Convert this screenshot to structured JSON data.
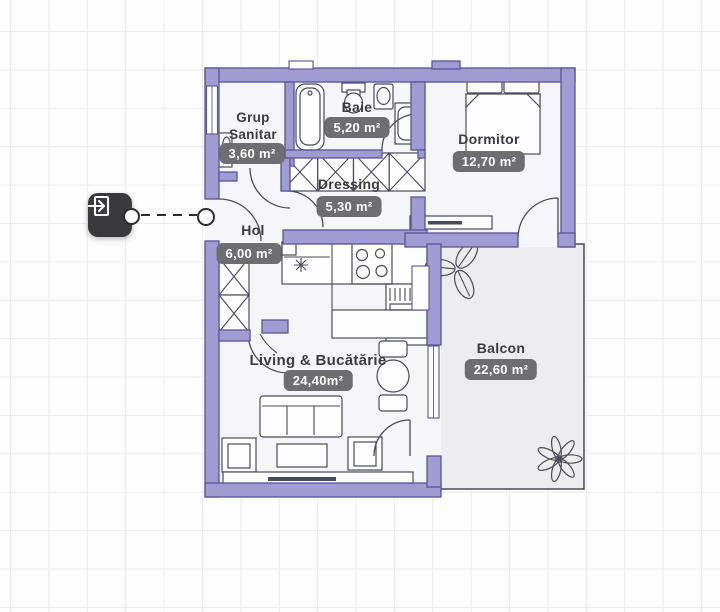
{
  "floor_plan": {
    "rooms": [
      {
        "name": "Grup Sanitar",
        "area": "3,60 m²"
      },
      {
        "name": "Baie",
        "area": "5,20 m²"
      },
      {
        "name": "Dormitor",
        "area": "12,70 m²"
      },
      {
        "name": "Dressing",
        "area": "5,30 m²"
      },
      {
        "name": "Hol",
        "area": "6,00 m²"
      },
      {
        "name": "Living & Bucătărie",
        "area": "24,40m²"
      },
      {
        "name": "Balcon",
        "area": "22,60 m²"
      }
    ],
    "entry_marker": {
      "icon": "door-enter-icon"
    },
    "colors": {
      "wall_fill": "#a19bd1",
      "wall_stroke": "#5a5499",
      "floor": "#f6f5f7",
      "balcony_floor": "#edecee",
      "badge_bg": "#6e6e70",
      "badge_text": "#ffffff",
      "label_text": "#3b3b40",
      "furniture_stroke": "#4a4a58",
      "entry_marker_bg": "#3a3a3c",
      "grid_line": "#ececec",
      "door_stroke": "#4b4b54"
    }
  }
}
